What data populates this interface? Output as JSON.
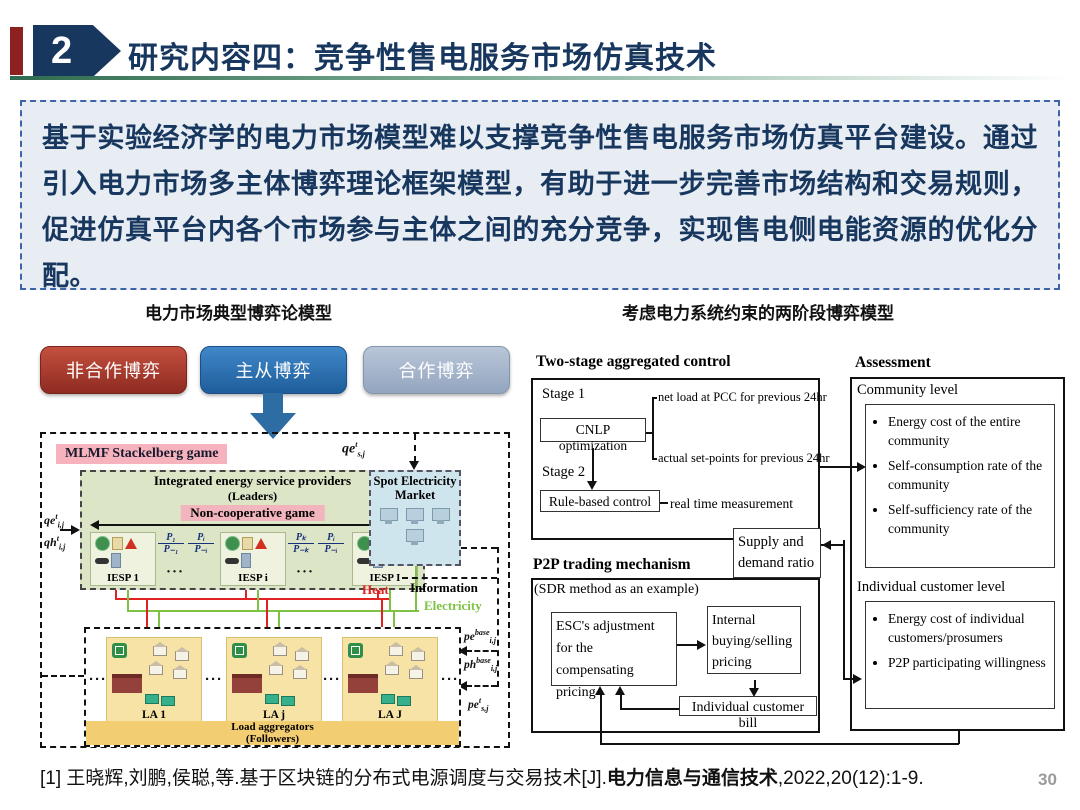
{
  "header": {
    "badge": "2",
    "title": "研究内容四：竞争性售电服务市场仿真技术"
  },
  "summary": "基于实验经济学的电力市场模型难以支撑竞争性售电服务市场仿真平台建设。通过引入电力市场多主体博弈理论框架模型，有助于进一步完善市场结构和交易规则，促进仿真平台内各个市场参与主体之间的充分竞争，实现售电侧电能资源的优化分配。",
  "left": {
    "title": "电力市场典型博弈论模型",
    "buttons": [
      {
        "label": "非合作博弈"
      },
      {
        "label": "主从博弈"
      },
      {
        "label": "合作博弈"
      }
    ],
    "diagram": {
      "game_label": "MLMF Stackelberg game",
      "leaders_title": "Integrated energy service providers",
      "leaders_sub": "(Leaders)",
      "noncoop": "Non-cooperative game",
      "iesp": [
        "IESP 1",
        "IESP i",
        "IESP I"
      ],
      "fractions": [
        {
          "t": "P₁",
          "b": "P₋₁"
        },
        {
          "t": "Pᵢ",
          "b": "P₋ᵢ"
        },
        {
          "t": "Pₖ",
          "b": "P₋ₖ"
        },
        {
          "t": "Pᵢ",
          "b": "P₋ᵢ"
        }
      ],
      "spot_title": "Spot Electricity Market",
      "heat": "Heat",
      "electricity": "Electricity",
      "information": "Information",
      "la": [
        "LA 1",
        "LA j",
        "LA J"
      ],
      "la_title": "Load aggregators",
      "la_sub": "(Followers)",
      "ellipsis": "···",
      "math": {
        "qe_top": {
          "base": "qe",
          "sup": "t",
          "sub": "s,j"
        },
        "qe_left": {
          "base": "qe",
          "sup": "t",
          "sub": "i,j"
        },
        "qh_left": {
          "base": "qh",
          "sup": "t",
          "sub": "i,j"
        },
        "pe_base": {
          "base": "pe",
          "sup": "base",
          "sub": "i,j"
        },
        "ph_base": {
          "base": "ph",
          "sup": "base",
          "sub": "i,j"
        },
        "pe_t": {
          "base": "pe",
          "sup": "t",
          "sub": "s,j"
        }
      }
    }
  },
  "right": {
    "title": "考虑电力系统约束的两阶段博弈模型",
    "flow": {
      "box1_title": "Two-stage aggregated control",
      "stage1": "Stage 1",
      "cnlp": "CNLP optimization",
      "net_load": "net load at PCC for previous 24hr",
      "set_points": "actual set-points for previous 24hr",
      "stage2": "Stage 2",
      "rule": "Rule-based control",
      "realtime": "real time measurement",
      "supply": "Supply and demand ratio",
      "p2p_title": "P2P trading mechanism",
      "sdr": "(SDR method as an example)",
      "esc": "ESC's adjustment for the compensating pricing",
      "internal": "Internal buying/selling pricing",
      "bill": "Individual customer bill",
      "assessment": "Assessment",
      "community": "Community level",
      "community_items": [
        "Energy cost of the entire community",
        "Self-consumption rate of the community",
        "Self-sufficiency rate of the community"
      ],
      "individual": "Individual customer level",
      "individual_items": [
        "Energy cost of individual customers/prosumers",
        "P2P participating willingness"
      ]
    }
  },
  "footer": {
    "ref_prefix": "[1]  王晓辉,刘鹏,侯聪,等.基于区块链的分布式电源调度与交易技术[J].",
    "ref_journal": "电力信息与通信技术",
    "ref_suffix": ",2022,20(12):1-9.",
    "page": "30"
  }
}
